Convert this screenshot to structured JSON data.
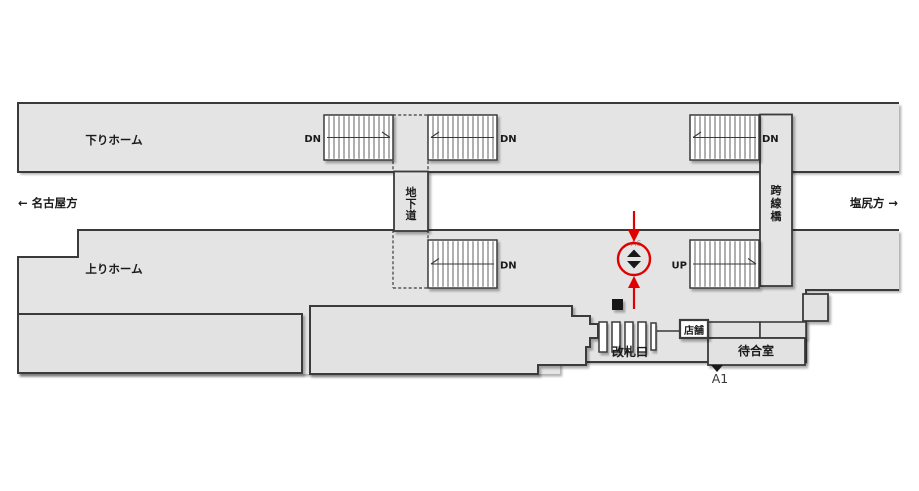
{
  "map": {
    "background": "#ffffff",
    "colors": {
      "platform_fill": "#e4e4e4",
      "building_fill": "#e2e2e2",
      "white_fill": "#ffffff",
      "outline": "#3a3a3a",
      "text": "#1a1a1a",
      "muted_text": "#979797",
      "marker_black": "#181818",
      "red": "#e10000"
    },
    "labels": {
      "down_platform": "下りホーム",
      "up_platform": "上りホーム",
      "dir_left": "← 名古屋方",
      "dir_right": "塩尻方 →",
      "underpass": "地下道",
      "overpass": "跨線橋",
      "gate": "改札口",
      "shop": "店舗",
      "waiting_room": "待合室",
      "exit": "A1",
      "elevator_code": "A6",
      "stair_down": "DN",
      "stair_up": "UP"
    },
    "geometry": {
      "canvas": {
        "w": 919,
        "h": 491
      },
      "down_platform": {
        "x": 18,
        "y": 103,
        "w": 881,
        "h": 69,
        "label_x": 114,
        "label_y": 144
      },
      "up_platform_points": "18,257 78,257 78,230 899,230 899,290 806,290 806,362 560,362 560,374 18,374",
      "up_platform_stroke": "M18,374 L18,257 L78,257 L78,230 L899,230 M899,290 L806,290 L806,362 L560,362",
      "up_platform_label": {
        "x": 114,
        "y": 273
      },
      "dir_left_pos": {
        "x": 18,
        "y": 207
      },
      "dir_right_pos": {
        "x": 898,
        "y": 207
      },
      "underpass": {
        "x": 394,
        "y": 171.5,
        "w": 34,
        "h": 59.5,
        "cx": 411,
        "char_y": [
          196,
          207.5,
          219
        ]
      },
      "overpass": {
        "x": 760,
        "y": 114.5,
        "w": 32,
        "h": 171.5,
        "cx": 776,
        "char_y": [
          194,
          207,
          220
        ]
      },
      "dashes": [
        "M393,115 L428,115",
        "M393,161 L393,172",
        "M428,161 L428,172",
        "M428,230 L428,240",
        "M393,230 L393,288",
        "M393,288 L428,288"
      ],
      "stairs": [
        {
          "x": 324,
          "y": 115,
          "w": 69,
          "h": 45,
          "label": "stair_down",
          "side": "left",
          "arrow": "right"
        },
        {
          "x": 428,
          "y": 115,
          "w": 69,
          "h": 45,
          "label": "stair_down",
          "side": "right",
          "arrow": "left"
        },
        {
          "x": 690,
          "y": 115,
          "w": 69,
          "h": 45,
          "label": "stair_down",
          "side": "right",
          "arrow": "left"
        },
        {
          "x": 428,
          "y": 240,
          "w": 69,
          "h": 48,
          "label": "stair_down",
          "side": "right",
          "arrow": "left"
        },
        {
          "x": 690,
          "y": 240,
          "w": 69,
          "h": 48,
          "label": "stair_up",
          "side": "left",
          "arrow": "right"
        }
      ],
      "left_building": {
        "x": 18,
        "y": 314,
        "w": 284,
        "h": 59
      },
      "middle_building_points": "310,306 572,306 572,316 590,316 590,324 598,324 598,338 590,338 590,347 586,347 586,365 538,365 538,374 310,374",
      "small_box": {
        "x": 803,
        "y": 294,
        "w": 25,
        "h": 27
      },
      "row_boxes": [
        {
          "x": 708,
          "y": 322,
          "w": 52,
          "h": 16
        },
        {
          "x": 760,
          "y": 322,
          "w": 46,
          "h": 16
        }
      ],
      "waiting_room": {
        "x": 708,
        "y": 338,
        "w": 97,
        "h": 27,
        "label_x": 756,
        "label_y": 355
      },
      "shop_box": {
        "x": 680,
        "y": 320,
        "w": 28,
        "h": 18,
        "label_x": 694,
        "label_y": 334
      },
      "gates": {
        "bars": [
          [
            599,
            322,
            8,
            30
          ],
          [
            612,
            322,
            8,
            30
          ],
          [
            625,
            322,
            8,
            30
          ],
          [
            638,
            322,
            8,
            30
          ],
          [
            651,
            323,
            5,
            27
          ]
        ],
        "connector": [
          657,
          331,
          680,
          331
        ],
        "black_square": [
          612,
          299,
          11,
          11
        ],
        "label_x": 630,
        "label_y": 356
      },
      "exit_marker": {
        "tri": "711,365 723,365 717,372",
        "label_x": 720,
        "label_y": 383
      },
      "annotation": {
        "cx": 634,
        "cy": 259,
        "r": 16,
        "code_x": 636,
        "code_y": 246,
        "arrow_top_line": [
          634,
          211,
          634,
          231
        ],
        "arrow_top_head": "628,230 640,230 634,242",
        "arrow_bottom_line": [
          634,
          309,
          634,
          287
        ],
        "arrow_bottom_head": "628,288 640,288 634,276",
        "tri_up": "634,249.5 641,257 627,257",
        "tri_down": "627,261 641,261 634,268.5"
      }
    }
  }
}
